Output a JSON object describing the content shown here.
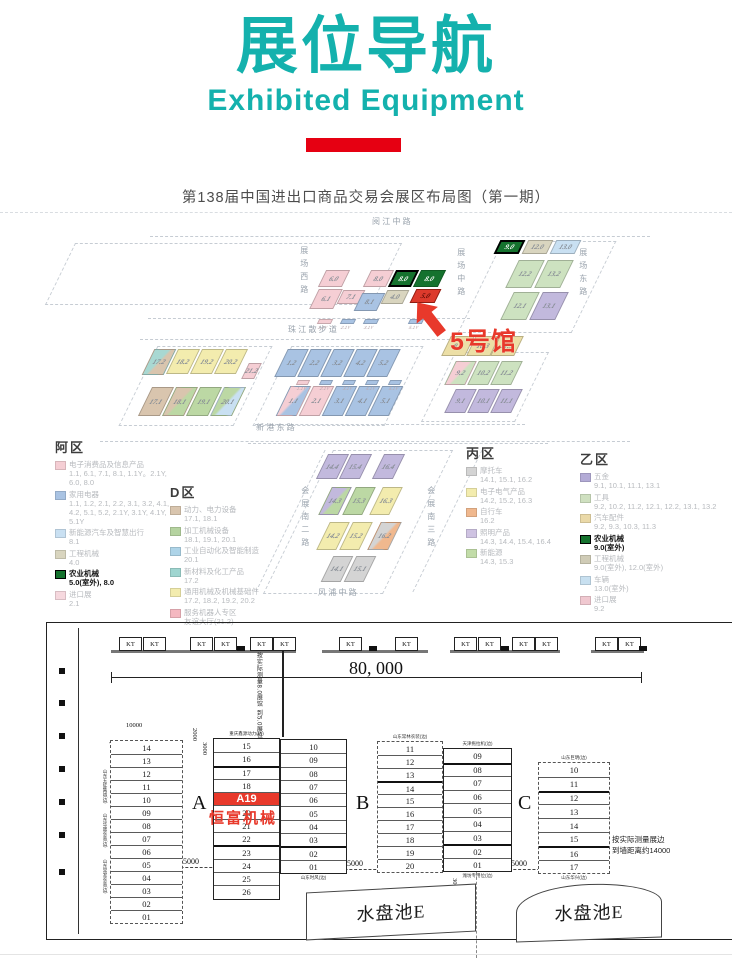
{
  "header": {
    "title": "展位导航",
    "subtitle": "Exhibited Equipment",
    "accent_teal": "#14b1ad",
    "accent_red_bar": "#e60012"
  },
  "map": {
    "title": "第138届中国进出口商品交易会展区布局图（第一期）",
    "hall5_callout": "5号馆",
    "accent_red": "#e8392b",
    "palette": {
      "pink": "#f5ced4",
      "blue": "#a9c3e3",
      "ltblue": "#c9e0f2",
      "beige": "#d9d5bf",
      "beige2": "#ecdfa6",
      "dkgreen": "#15722e",
      "red": "#dd3a2c",
      "ltgreen": "#cde2c0",
      "green": "#bcd8a4",
      "purple": "#c2b9dd",
      "yellow": "#f3ecae",
      "teal": "#a8d8d2",
      "tan": "#d9c5ae",
      "orange": "#f0b88e",
      "gray": "#d4d4d4"
    },
    "roads": [
      {
        "t": "阅 江 中 路",
        "x": 372,
        "y": 218
      },
      {
        "t": "展场西路",
        "x": 299,
        "y": 246,
        "v": 1
      },
      {
        "t": "展场中路",
        "x": 456,
        "y": 248,
        "v": 1
      },
      {
        "t": "展场东路",
        "x": 578,
        "y": 248,
        "v": 1
      },
      {
        "t": "珠 江 散 步 道",
        "x": 288,
        "y": 326
      },
      {
        "t": "新 港 东 路",
        "x": 256,
        "y": 424
      },
      {
        "t": "会展南二路",
        "x": 300,
        "y": 486,
        "v": 1
      },
      {
        "t": "会展南三路",
        "x": 426,
        "y": 486,
        "v": 1
      },
      {
        "t": "风 浦 中 路",
        "x": 318,
        "y": 589
      }
    ],
    "dashes": [
      {
        "x": 60,
        "y": 243,
        "w": 325,
        "h": 60,
        "sk": -26
      },
      {
        "x": 480,
        "y": 241,
        "w": 112,
        "h": 90,
        "sk": -26
      },
      {
        "x": 138,
        "y": 346,
        "w": 113,
        "h": 78,
        "sk": -26
      },
      {
        "x": 272,
        "y": 346,
        "w": 130,
        "h": 78,
        "sk": -26
      },
      {
        "x": 438,
        "y": 352,
        "w": 92,
        "h": 68,
        "sk": -26
      },
      {
        "x": 298,
        "y": 450,
        "w": 118,
        "h": 142,
        "sk": -26
      },
      {
        "x": 150,
        "y": 236,
        "w": 500,
        "h": 0
      },
      {
        "x": 148,
        "y": 318,
        "w": 322,
        "h": 0
      },
      {
        "x": 140,
        "y": 339,
        "w": 325,
        "h": 0
      },
      {
        "x": 255,
        "y": 424,
        "w": 270,
        "h": 0
      },
      {
        "x": 248,
        "y": 443,
        "w": 300,
        "h": 0
      },
      {
        "x": 100,
        "y": 441,
        "w": 530,
        "h": 0
      },
      {
        "x": 447,
        "y": 450,
        "w": 0,
        "h": 142,
        "sk": -26
      },
      {
        "x": 290,
        "y": 450,
        "w": 0,
        "h": 142,
        "sk": -26
      }
    ],
    "blocks": [
      {
        "t": "6.0",
        "x": 322,
        "y": 270,
        "w": 24,
        "h": 17,
        "c": "pink"
      },
      {
        "t": "8.0",
        "x": 367,
        "y": 270,
        "w": 23,
        "h": 17,
        "c": "pink"
      },
      {
        "t": "8.0",
        "x": 392,
        "y": 270,
        "w": 23,
        "h": 17,
        "c": "dkgreen",
        "bd": "#000",
        "bw": 2,
        "tc": "#fff"
      },
      {
        "t": "8.0",
        "x": 417,
        "y": 270,
        "w": 25,
        "h": 17,
        "c": "dkgreen",
        "tc": "#fff"
      },
      {
        "t": "6.1",
        "x": 314,
        "y": 289,
        "w": 24,
        "h": 20,
        "c": "pink"
      },
      {
        "t": "7.1",
        "x": 340,
        "y": 290,
        "w": 22,
        "h": 14,
        "c": "pink"
      },
      {
        "t": "8.1",
        "x": 358,
        "y": 293,
        "w": 23,
        "h": 18,
        "c": "blue"
      },
      {
        "t": "4.0",
        "x": 384,
        "y": 290,
        "w": 22,
        "h": 14,
        "c": "beige"
      },
      {
        "t": "5.0",
        "x": 413,
        "y": 289,
        "w": 25,
        "h": 14,
        "c": "red",
        "bd": "#8f1d12",
        "tc": "#5f0c06"
      },
      {
        "t": "9.0",
        "x": 497,
        "y": 240,
        "w": 25,
        "h": 14,
        "c": "dkgreen",
        "bd": "#000",
        "bw": 2,
        "tc": "#fff"
      },
      {
        "t": "12.0",
        "x": 525,
        "y": 240,
        "w": 25,
        "h": 14,
        "c": "beige"
      },
      {
        "t": "13.0",
        "x": 553,
        "y": 240,
        "w": 25,
        "h": 14,
        "c": "ltblue"
      },
      {
        "t": "12.2",
        "x": 512,
        "y": 260,
        "w": 26,
        "h": 28,
        "c": "ltgreen"
      },
      {
        "t": "13.2",
        "x": 541,
        "y": 260,
        "w": 26,
        "h": 28,
        "c": "ltgreen"
      },
      {
        "t": "12.1",
        "x": 507,
        "y": 292,
        "w": 26,
        "h": 28,
        "c": "ltgreen"
      },
      {
        "t": "13.1",
        "x": 536,
        "y": 292,
        "w": 26,
        "h": 28,
        "c": "purple"
      },
      {
        "t": "17.2",
        "x": 148,
        "y": 349,
        "w": 22,
        "h": 26,
        "c": "teal",
        "c2": "tan"
      },
      {
        "t": "18.2",
        "x": 172,
        "y": 349,
        "w": 22,
        "h": 25,
        "c": "yellow"
      },
      {
        "t": "19.2",
        "x": 196,
        "y": 349,
        "w": 22,
        "h": 25,
        "c": "yellow"
      },
      {
        "t": "20.2",
        "x": 220,
        "y": 349,
        "w": 22,
        "h": 25,
        "c": "yellow"
      },
      {
        "t": "21.2",
        "x": 245,
        "y": 363,
        "w": 13,
        "h": 16,
        "c": "pink"
      },
      {
        "t": "17.1",
        "x": 145,
        "y": 387,
        "w": 22,
        "h": 29,
        "c": "tan"
      },
      {
        "t": "18.1",
        "x": 169,
        "y": 387,
        "w": 22,
        "h": 29,
        "c": "tan",
        "c2": "green"
      },
      {
        "t": "19.1",
        "x": 193,
        "y": 387,
        "w": 22,
        "h": 29,
        "c": "green"
      },
      {
        "t": "20.1",
        "x": 217,
        "y": 387,
        "w": 22,
        "h": 29,
        "c": "green",
        "c2": "ltblue"
      },
      {
        "t": "1.2",
        "x": 281,
        "y": 349,
        "w": 21,
        "h": 28,
        "c": "blue"
      },
      {
        "t": "2.2",
        "x": 304,
        "y": 349,
        "w": 21,
        "h": 28,
        "c": "blue"
      },
      {
        "t": "3.2",
        "x": 327,
        "y": 349,
        "w": 21,
        "h": 28,
        "c": "blue"
      },
      {
        "t": "4.2",
        "x": 350,
        "y": 349,
        "w": 21,
        "h": 28,
        "c": "blue"
      },
      {
        "t": "5.2",
        "x": 373,
        "y": 349,
        "w": 21,
        "h": 28,
        "c": "blue"
      },
      {
        "t": "1.1",
        "x": 283,
        "y": 386,
        "w": 21,
        "h": 30,
        "c": "pink",
        "c2": "blue"
      },
      {
        "t": "2.1",
        "x": 306,
        "y": 386,
        "w": 21,
        "h": 30,
        "c": "pink"
      },
      {
        "t": "3.1",
        "x": 329,
        "y": 386,
        "w": 21,
        "h": 30,
        "c": "blue"
      },
      {
        "t": "4.1",
        "x": 352,
        "y": 386,
        "w": 21,
        "h": 30,
        "c": "blue"
      },
      {
        "t": "5.1",
        "x": 375,
        "y": 386,
        "w": 21,
        "h": 30,
        "c": "blue"
      },
      {
        "t": "9.3",
        "x": 446,
        "y": 336,
        "w": 24,
        "h": 20,
        "c": "beige2"
      },
      {
        "t": "10.3",
        "x": 471,
        "y": 336,
        "w": 24,
        "h": 20,
        "c": "beige2"
      },
      {
        "t": "11.3",
        "x": 495,
        "y": 336,
        "w": 24,
        "h": 20,
        "c": "beige2"
      },
      {
        "t": "9.2",
        "x": 450,
        "y": 361,
        "w": 21,
        "h": 24,
        "c": "pink",
        "c2": "ltgreen"
      },
      {
        "t": "10.2",
        "x": 473,
        "y": 361,
        "w": 21,
        "h": 24,
        "c": "ltgreen"
      },
      {
        "t": "11.2",
        "x": 496,
        "y": 361,
        "w": 21,
        "h": 24,
        "c": "ltgreen"
      },
      {
        "t": "9.1",
        "x": 450,
        "y": 389,
        "w": 21,
        "h": 24,
        "c": "purple"
      },
      {
        "t": "10.1",
        "x": 473,
        "y": 389,
        "w": 21,
        "h": 24,
        "c": "purple"
      },
      {
        "t": "11.1",
        "x": 496,
        "y": 389,
        "w": 21,
        "h": 24,
        "c": "purple"
      },
      {
        "t": "14.4",
        "x": 322,
        "y": 454,
        "w": 21,
        "h": 25,
        "c": "purple"
      },
      {
        "t": "15.4",
        "x": 345,
        "y": 454,
        "w": 21,
        "h": 25,
        "c": "purple"
      },
      {
        "t": "16.4",
        "x": 378,
        "y": 454,
        "w": 21,
        "h": 25,
        "c": "purple"
      },
      {
        "t": "14.3",
        "x": 325,
        "y": 487,
        "w": 20,
        "h": 28,
        "c": "purple",
        "c2": "green"
      },
      {
        "t": "15.3",
        "x": 349,
        "y": 487,
        "w": 20,
        "h": 28,
        "c": "green"
      },
      {
        "t": "16.3",
        "x": 376,
        "y": 487,
        "w": 20,
        "h": 28,
        "c": "yellow"
      },
      {
        "t": "14.2",
        "x": 323,
        "y": 522,
        "w": 20,
        "h": 28,
        "c": "yellow"
      },
      {
        "t": "15.2",
        "x": 346,
        "y": 522,
        "w": 20,
        "h": 28,
        "c": "yellow"
      },
      {
        "t": "16.2",
        "x": 374,
        "y": 522,
        "w": 21,
        "h": 28,
        "c": "gray",
        "c2": "orange"
      },
      {
        "t": "14.1",
        "x": 327,
        "y": 556,
        "w": 20,
        "h": 26,
        "c": "gray"
      },
      {
        "t": "15.1",
        "x": 350,
        "y": 556,
        "w": 20,
        "h": 26,
        "c": "gray"
      }
    ],
    "strips": [
      {
        "t": "1.1Y",
        "x": 318,
        "y": 319,
        "w": 14,
        "c": "pink"
      },
      {
        "t": "2.1Y",
        "x": 341,
        "y": 319,
        "w": 14,
        "c": "blue"
      },
      {
        "t": "3.1Y",
        "x": 364,
        "y": 319,
        "w": 14,
        "c": "blue"
      },
      {
        "t": "5.1Y",
        "x": 409,
        "y": 319,
        "w": 14,
        "c": "blue"
      },
      {
        "t": "1.1Y",
        "x": 297,
        "y": 380,
        "w": 12,
        "c": "pink"
      },
      {
        "t": "2.1Y",
        "x": 320,
        "y": 380,
        "w": 12,
        "c": "blue"
      },
      {
        "t": "3.1Y",
        "x": 343,
        "y": 380,
        "w": 12,
        "c": "blue"
      },
      {
        "t": "4.1Y",
        "x": 366,
        "y": 380,
        "w": 12,
        "c": "blue"
      },
      {
        "t": "5.1Y",
        "x": 389,
        "y": 380,
        "w": 12,
        "c": "blue"
      }
    ],
    "legends": [
      {
        "title": "阿区",
        "x": 55,
        "y": 437,
        "w": 122,
        "items": [
          {
            "c": "#f5ced4",
            "name": "电子消费品及信息产品",
            "halls": "1.1, 6.1, 7.1, 8.1, 1.1Y。2.1Y, 6.0, 8.0"
          },
          {
            "c": "#a9c3e3",
            "name": "家用电器",
            "halls": "1.1, 1.2, 2.1, 2.2, 3.1, 3.2, 4.1, 4.2, 5.1, 5.2, 2.1Y, 3.1Y, 4.1Y, 5.1Y"
          },
          {
            "c": "#c9e0f2",
            "name": "新能源汽车及智慧出行",
            "halls": "8.1"
          },
          {
            "c": "#d9d5bf",
            "name": "工程机械",
            "halls": "4.0"
          },
          {
            "c": "#15722e",
            "name": "农业机械",
            "halls": "5.0(室外), 8.0",
            "b": 1
          },
          {
            "c": "#f6d8de",
            "name": "进口展",
            "halls": "2.1"
          }
        ]
      },
      {
        "title": "D区",
        "x": 170,
        "y": 482,
        "w": 120,
        "items": [
          {
            "c": "#d9c5ae",
            "name": "动力、电力设备",
            "halls": "17.1, 18.1"
          },
          {
            "c": "#b5d3a0",
            "name": "加工机械设备",
            "halls": "18.1, 19.1, 20.1"
          },
          {
            "c": "#aed4e8",
            "name": "工业自动化及智能制造",
            "halls": "20.1"
          },
          {
            "c": "#9fd5d0",
            "name": "新材料及化工产品",
            "halls": "17.2"
          },
          {
            "c": "#f3ecae",
            "name": "通用机械及机械基础件",
            "halls": "17.2, 18.2, 19.2, 20.2"
          },
          {
            "c": "#f4b8c0",
            "name": "服务机器人专区",
            "halls": "友谊大厅(21.2)"
          }
        ]
      },
      {
        "title": "丙区",
        "x": 466,
        "y": 443,
        "w": 112,
        "items": [
          {
            "c": "#d4d4d4",
            "name": "摩托车",
            "halls": "14.1, 15.1, 16.2"
          },
          {
            "c": "#f3ecae",
            "name": "电子电气产品",
            "halls": "14.2, 15.2, 16.3"
          },
          {
            "c": "#f0b88e",
            "name": "自行车",
            "halls": "16.2"
          },
          {
            "c": "#cfc3e2",
            "name": "照明产品",
            "halls": "14.3, 14.4, 15.4, 16.4"
          },
          {
            "c": "#c2dca8",
            "name": "新能源",
            "halls": "14.3, 15.3"
          }
        ]
      },
      {
        "title": "乙区",
        "x": 580,
        "y": 449,
        "w": 145,
        "items": [
          {
            "c": "#b3abd6",
            "name": "五金",
            "halls": "9.1, 10.1, 11.1, 13.1"
          },
          {
            "c": "#cfe0c0",
            "name": "工具",
            "halls": "9.2, 10.2, 11.2, 12.1, 12.2, 13.1, 13.2"
          },
          {
            "c": "#ead9a8",
            "name": "汽车配件",
            "halls": "9.2, 9.3, 10.3, 11.3"
          },
          {
            "c": "#15722e",
            "name": "农业机械",
            "halls": "9.0(室外)",
            "b": 1
          },
          {
            "c": "#cfcbb6",
            "name": "工程机械",
            "halls": "9.0(室外), 12.0(室外)"
          },
          {
            "c": "#c8e0f0",
            "name": "车辆",
            "halls": "13.0(室外)"
          },
          {
            "c": "#f0c8d0",
            "name": "进口展",
            "halls": "9.2"
          }
        ]
      }
    ]
  },
  "plan": {
    "border": {
      "x": 46,
      "y": 622,
      "w": 688,
      "h": 318
    },
    "left_wall_x": 78,
    "wall_y": 650,
    "walls": [
      [
        111,
        296
      ],
      [
        322,
        428
      ],
      [
        450,
        560
      ],
      [
        591,
        644
      ]
    ],
    "kt_label": "KT",
    "kts": [
      119,
      143,
      190,
      214,
      250,
      273,
      339,
      395,
      454,
      478,
      512,
      535,
      595,
      618
    ],
    "notches": [
      237,
      369,
      501,
      639
    ],
    "ticks": [
      668,
      700,
      733,
      766,
      799,
      832,
      869
    ],
    "dim80": {
      "x1": 111,
      "x2": 641,
      "y": 677,
      "label": "80, 000"
    },
    "vnote": {
      "x": 252,
      "y": 652,
      "lines": [
        "按实际测量8.0展馆",
        "到5.0展位约17000"
      ]
    },
    "vline": {
      "x": 282,
      "y1": 650,
      "y2": 737
    },
    "sec_labels": [
      {
        "t": "A",
        "x": 192,
        "y": 792
      },
      {
        "t": "B",
        "x": 356,
        "y": 792
      },
      {
        "t": "C",
        "x": 518,
        "y": 792
      }
    ],
    "dims5000": [
      {
        "t": "5000",
        "x": 183,
        "y": 857
      },
      {
        "t": "5000",
        "x": 347,
        "y": 859
      },
      {
        "t": "5000",
        "x": 511,
        "y": 859
      }
    ],
    "dims_small": [
      {
        "t": "10000",
        "x": 126,
        "y": 722
      },
      {
        "t": "2000",
        "x": 191,
        "y": 728,
        "v": 1
      },
      {
        "t": "3000",
        "x": 201,
        "y": 742,
        "v": 1
      },
      {
        "t": "3000",
        "x": 451,
        "y": 878,
        "v": 1
      }
    ],
    "note_right": {
      "x": 612,
      "y": 834,
      "lines": [
        "按实际测量展边",
        "到墙距离约14000"
      ]
    },
    "pools": [
      {
        "t": "水盘池E",
        "x": 306,
        "y": 888,
        "w": 170,
        "h": 48,
        "style": "skew"
      },
      {
        "t": "水盘池E",
        "x": 516,
        "y": 884,
        "w": 146,
        "h": 56,
        "style": "arc"
      }
    ],
    "pool_dash_x": 476,
    "diagonals": [
      {
        "x": 110,
        "y": 742,
        "len": 105,
        "ang": 45.8
      },
      {
        "x": 214,
        "y": 764,
        "len": 69,
        "ang": -18.5
      }
    ],
    "columns": [
      {
        "x": 110,
        "y": 740,
        "w": 73,
        "rh": 13,
        "outer": "dashed",
        "rows": [
          "14",
          "13",
          "12",
          "11",
          "10",
          "09",
          "08",
          "07",
          "06",
          "05",
          "04",
          "03",
          "02",
          "01"
        ],
        "left_labels": [
          {
            "t": "山东五征集团(边)",
            "y": 28
          },
          {
            "t": "山东华盛农装(边)",
            "y": 72
          },
          {
            "t": "山东常发农装(边)",
            "y": 118
          }
        ]
      },
      {
        "x": 213,
        "y": 738,
        "w": 67,
        "rh": 13.3,
        "outer": "solid",
        "rows": [
          "15",
          "16",
          "17",
          "18",
          "A19",
          "20",
          "21",
          "22",
          "23",
          "24",
          "25",
          "26"
        ],
        "red": 4,
        "sub": "恒富机械",
        "top_label": "重庆鑫源动力(边)",
        "bold": [
          2,
          8
        ]
      },
      {
        "x": 280,
        "y": 739,
        "w": 67,
        "rh": 13.3,
        "outer": "solid",
        "rows": [
          "10",
          "09",
          "08",
          "07",
          "06",
          "05",
          "04",
          "03",
          "02",
          "01"
        ],
        "bottom_label": "山东时风(边)",
        "bold": [
          8
        ]
      },
      {
        "x": 377,
        "y": 741,
        "w": 66,
        "rh": 13,
        "outer": "dashed",
        "rows": [
          "11",
          "12",
          "13",
          "14",
          "15",
          "16",
          "17",
          "18",
          "19",
          "20"
        ],
        "top_label": "山东常林农装(边)",
        "bold": [
          3
        ]
      },
      {
        "x": 443,
        "y": 748,
        "w": 69,
        "rh": 13.6,
        "outer": "solid",
        "rows": [
          "09",
          "08",
          "07",
          "06",
          "05",
          "04",
          "03",
          "02",
          "01"
        ],
        "top_label": "天津拖拉机(边)",
        "bottom_label": "潍坊专用位(边)",
        "bold": [
          1,
          7
        ]
      },
      {
        "x": 538,
        "y": 762,
        "w": 72,
        "rh": 13.8,
        "outer": "dashed",
        "rows": [
          "10",
          "11",
          "12",
          "13",
          "14",
          "15",
          "16",
          "17"
        ],
        "top_label": "山东巨明(边)",
        "bottom_label": "山东华兴(边)",
        "bold": [
          2,
          6
        ]
      }
    ]
  }
}
